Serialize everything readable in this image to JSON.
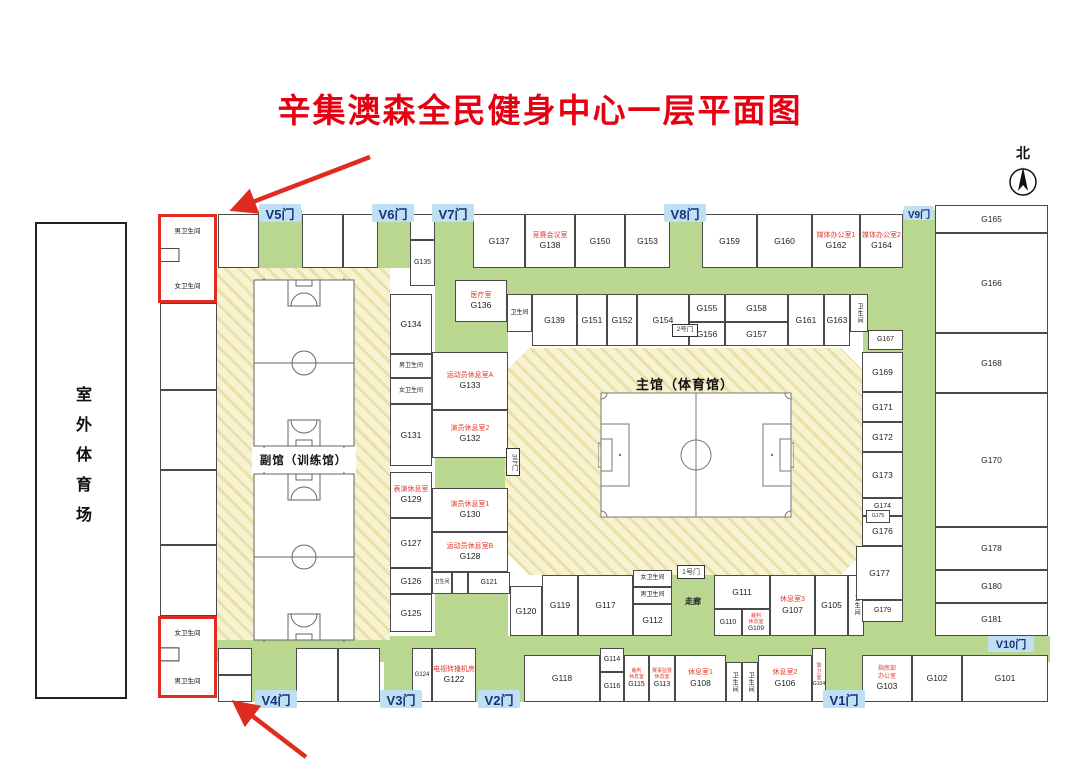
{
  "title": "辛集澳森全民健身中心一层平面图",
  "compass_label": "北",
  "labels": {
    "outdoor": "室外体育场",
    "training": "副馆（训练馆）",
    "main": "主馆（体育馆）",
    "corridor": "走廊"
  },
  "colors": {
    "title_red": "#e60012",
    "annotation_red": "#e02b20",
    "corridor_green": "#b9d78e",
    "door_bg": "#bfe0f2",
    "door_text": "#1b2f7e",
    "hatch_base": "#f7f2d0"
  },
  "entrance_doors": [
    {
      "label": "V5门",
      "x": 259,
      "y": 204,
      "w": 42,
      "h": 18,
      "fs": 13
    },
    {
      "label": "V6门",
      "x": 372,
      "y": 204,
      "w": 42,
      "h": 18,
      "fs": 13
    },
    {
      "label": "V7门",
      "x": 432,
      "y": 204,
      "w": 42,
      "h": 18,
      "fs": 13
    },
    {
      "label": "V8门",
      "x": 664,
      "y": 204,
      "w": 42,
      "h": 18,
      "fs": 13
    },
    {
      "label": "V9门",
      "x": 904,
      "y": 206,
      "w": 30,
      "h": 14,
      "fs": 10
    },
    {
      "label": "V10门",
      "x": 988,
      "y": 636,
      "w": 46,
      "h": 16,
      "fs": 11
    },
    {
      "label": "V1门",
      "x": 823,
      "y": 690,
      "w": 42,
      "h": 18,
      "fs": 13
    },
    {
      "label": "V2门",
      "x": 478,
      "y": 690,
      "w": 42,
      "h": 18,
      "fs": 13
    },
    {
      "label": "V3门",
      "x": 380,
      "y": 690,
      "w": 42,
      "h": 18,
      "fs": 13
    },
    {
      "label": "V4门",
      "x": 255,
      "y": 690,
      "w": 42,
      "h": 18,
      "fs": 13
    }
  ],
  "inner_doors": [
    {
      "label": "1号门",
      "x": 677,
      "y": 565,
      "w": 26,
      "h": 12,
      "fs": 7
    },
    {
      "label": "2号门",
      "x": 672,
      "y": 324,
      "w": 24,
      "h": 11,
      "fs": 6.5
    },
    {
      "label": "3号门",
      "x": 506,
      "y": 448,
      "w": 12,
      "h": 26,
      "fs": 6.5,
      "v": 1
    }
  ],
  "corridors": [
    {
      "x": 258,
      "y": 210,
      "w": 44,
      "h": 58
    },
    {
      "x": 378,
      "y": 210,
      "w": 32,
      "h": 58
    },
    {
      "x": 435,
      "y": 210,
      "w": 38,
      "h": 84
    },
    {
      "x": 670,
      "y": 210,
      "w": 32,
      "h": 84
    },
    {
      "x": 903,
      "y": 210,
      "w": 32,
      "h": 452
    },
    {
      "x": 435,
      "y": 268,
      "w": 468,
      "h": 26
    },
    {
      "x": 435,
      "y": 294,
      "w": 73,
      "h": 342
    },
    {
      "x": 863,
      "y": 294,
      "w": 40,
      "h": 342
    },
    {
      "x": 215,
      "y": 636,
      "w": 835,
      "h": 26
    },
    {
      "x": 672,
      "y": 566,
      "w": 42,
      "h": 70
    },
    {
      "x": 250,
      "y": 640,
      "w": 46,
      "h": 62
    },
    {
      "x": 384,
      "y": 640,
      "w": 28,
      "h": 62
    },
    {
      "x": 476,
      "y": 640,
      "w": 48,
      "h": 62
    },
    {
      "x": 826,
      "y": 640,
      "w": 36,
      "h": 62
    },
    {
      "x": 203,
      "y": 452,
      "w": 14,
      "h": 20
    }
  ],
  "red_boxes": [
    {
      "x": 158,
      "y": 214,
      "w": 59,
      "h": 89,
      "top_label": "男卫生间",
      "bottom_label": "女卫生间"
    },
    {
      "x": 158,
      "y": 616,
      "w": 59,
      "h": 82,
      "top_label": "女卫生间",
      "bottom_label": "男卫生间"
    }
  ],
  "arrows": [
    {
      "x1": 370,
      "y1": 157,
      "x2": 237,
      "y2": 208
    },
    {
      "x1": 306,
      "y1": 757,
      "x2": 238,
      "y2": 705
    }
  ],
  "rooms": [
    {
      "l": "",
      "x": 218,
      "y": 214,
      "w": 41,
      "h": 54
    },
    {
      "l": "",
      "x": 302,
      "y": 214,
      "w": 41,
      "h": 54
    },
    {
      "l": "",
      "x": 343,
      "y": 214,
      "w": 35,
      "h": 54
    },
    {
      "l": "",
      "x": 410,
      "y": 214,
      "w": 25,
      "h": 26
    },
    {
      "l": "G135",
      "x": 410,
      "y": 240,
      "w": 25,
      "h": 46,
      "fs": 7
    },
    {
      "l": "G137",
      "x": 473,
      "y": 214,
      "w": 52,
      "h": 54
    },
    {
      "l": "G138",
      "r": "竞赛会议室",
      "x": 525,
      "y": 214,
      "w": 50,
      "h": 54
    },
    {
      "l": "G150",
      "x": 575,
      "y": 214,
      "w": 50,
      "h": 54
    },
    {
      "l": "G153",
      "x": 625,
      "y": 214,
      "w": 45,
      "h": 54
    },
    {
      "l": "G159",
      "x": 702,
      "y": 214,
      "w": 55,
      "h": 54
    },
    {
      "l": "G160",
      "x": 757,
      "y": 214,
      "w": 55,
      "h": 54
    },
    {
      "l": "G162",
      "r": "媒体办公室1",
      "x": 812,
      "y": 214,
      "w": 48,
      "h": 54
    },
    {
      "l": "G164",
      "r": "媒体办公室2",
      "x": 860,
      "y": 214,
      "w": 43,
      "h": 54
    },
    {
      "l": "",
      "x": 160,
      "y": 303,
      "w": 57,
      "h": 87
    },
    {
      "l": "",
      "x": 160,
      "y": 390,
      "w": 57,
      "h": 80
    },
    {
      "l": "",
      "x": 160,
      "y": 470,
      "w": 57,
      "h": 75
    },
    {
      "l": "",
      "x": 160,
      "y": 545,
      "w": 57,
      "h": 71
    },
    {
      "l": "G136",
      "r": "医疗室",
      "x": 455,
      "y": 280,
      "w": 52,
      "h": 42
    },
    {
      "l": "卫生间",
      "x": 507,
      "y": 294,
      "w": 25,
      "h": 38,
      "fs": 6
    },
    {
      "l": "G139",
      "x": 532,
      "y": 294,
      "w": 45,
      "h": 52
    },
    {
      "l": "G151",
      "x": 577,
      "y": 294,
      "w": 30,
      "h": 52
    },
    {
      "l": "G152",
      "x": 607,
      "y": 294,
      "w": 30,
      "h": 52
    },
    {
      "l": "G154",
      "x": 637,
      "y": 294,
      "w": 52,
      "h": 52
    },
    {
      "l": "G155",
      "x": 689,
      "y": 294,
      "w": 36,
      "h": 28
    },
    {
      "l": "G156",
      "x": 689,
      "y": 322,
      "w": 36,
      "h": 24
    },
    {
      "l": "G158",
      "x": 725,
      "y": 294,
      "w": 63,
      "h": 28
    },
    {
      "l": "G157",
      "x": 725,
      "y": 322,
      "w": 63,
      "h": 24
    },
    {
      "l": "G161",
      "x": 788,
      "y": 294,
      "w": 36,
      "h": 52
    },
    {
      "l": "G163",
      "x": 824,
      "y": 294,
      "w": 26,
      "h": 52
    },
    {
      "l": "卫生间",
      "x": 850,
      "y": 294,
      "w": 18,
      "h": 38,
      "v": 1,
      "fs": 6
    },
    {
      "l": "G134",
      "x": 390,
      "y": 294,
      "w": 42,
      "h": 60
    },
    {
      "l": "男卫生间",
      "x": 390,
      "y": 354,
      "w": 42,
      "h": 24,
      "fs": 6
    },
    {
      "l": "女卫生间",
      "x": 390,
      "y": 378,
      "w": 42,
      "h": 26,
      "fs": 6
    },
    {
      "l": "G131",
      "x": 390,
      "y": 404,
      "w": 42,
      "h": 62
    },
    {
      "l": "G129",
      "r": "表演休息室",
      "x": 390,
      "y": 472,
      "w": 42,
      "h": 46
    },
    {
      "l": "G127",
      "x": 390,
      "y": 518,
      "w": 42,
      "h": 50
    },
    {
      "l": "G126",
      "x": 390,
      "y": 568,
      "w": 42,
      "h": 26
    },
    {
      "l": "G125",
      "x": 390,
      "y": 594,
      "w": 42,
      "h": 38
    },
    {
      "l": "G133",
      "r": "运动员休息室A",
      "x": 432,
      "y": 352,
      "w": 76,
      "h": 58
    },
    {
      "l": "G132",
      "r": "演员休息室2",
      "x": 432,
      "y": 410,
      "w": 76,
      "h": 48
    },
    {
      "l": "G130",
      "r": "演员休息室1",
      "x": 432,
      "y": 488,
      "w": 76,
      "h": 44
    },
    {
      "l": "G128",
      "r": "运动员休息室B",
      "x": 432,
      "y": 532,
      "w": 76,
      "h": 40
    },
    {
      "l": "卫生间",
      "x": 432,
      "y": 572,
      "w": 20,
      "h": 22,
      "fs": 5
    },
    {
      "l": "",
      "x": 452,
      "y": 572,
      "w": 16,
      "h": 22
    },
    {
      "l": "G121",
      "x": 468,
      "y": 572,
      "w": 42,
      "h": 22,
      "fs": 7
    },
    {
      "l": "G120",
      "x": 510,
      "y": 586,
      "w": 32,
      "h": 50
    },
    {
      "l": "G119",
      "x": 542,
      "y": 575,
      "w": 36,
      "h": 61
    },
    {
      "l": "G117",
      "x": 578,
      "y": 575,
      "w": 55,
      "h": 61
    },
    {
      "l": "女卫生间",
      "x": 633,
      "y": 570,
      "w": 39,
      "h": 17,
      "fs": 6
    },
    {
      "l": "男卫生间",
      "x": 633,
      "y": 587,
      "w": 39,
      "h": 17,
      "fs": 6
    },
    {
      "l": "G112",
      "x": 633,
      "y": 604,
      "w": 39,
      "h": 32
    },
    {
      "l": "G111",
      "x": 714,
      "y": 575,
      "w": 56,
      "h": 34
    },
    {
      "l": "G110",
      "x": 714,
      "y": 609,
      "w": 28,
      "h": 27,
      "fs": 7
    },
    {
      "l": "G109",
      "r": "裁判\n休息室",
      "x": 742,
      "y": 609,
      "w": 28,
      "h": 27,
      "fs": 6.5,
      "rfs": 5
    },
    {
      "l": "G107",
      "r": "休息室3",
      "x": 770,
      "y": 575,
      "w": 45,
      "h": 61
    },
    {
      "l": "G105",
      "x": 815,
      "y": 575,
      "w": 33,
      "h": 61
    },
    {
      "l": "卫生间",
      "x": 848,
      "y": 575,
      "w": 16,
      "h": 61,
      "v": 1,
      "fs": 6
    },
    {
      "l": "G167",
      "x": 868,
      "y": 330,
      "w": 35,
      "h": 20,
      "fs": 7
    },
    {
      "l": "G169",
      "x": 862,
      "y": 352,
      "w": 41,
      "h": 40
    },
    {
      "l": "G171",
      "x": 862,
      "y": 392,
      "w": 41,
      "h": 30
    },
    {
      "l": "G172",
      "x": 862,
      "y": 422,
      "w": 41,
      "h": 30
    },
    {
      "l": "G173",
      "x": 862,
      "y": 452,
      "w": 41,
      "h": 46
    },
    {
      "l": "G174",
      "x": 862,
      "y": 498,
      "w": 41,
      "h": 18,
      "fs": 7
    },
    {
      "l": "G176",
      "x": 862,
      "y": 516,
      "w": 41,
      "h": 30
    },
    {
      "l": "G175",
      "x": 866,
      "y": 510,
      "w": 24,
      "h": 13,
      "fs": 5
    },
    {
      "l": "G177",
      "x": 856,
      "y": 546,
      "w": 47,
      "h": 54
    },
    {
      "l": "G179",
      "x": 862,
      "y": 600,
      "w": 41,
      "h": 22,
      "fs": 7
    },
    {
      "l": "G165",
      "x": 935,
      "y": 205,
      "w": 113,
      "h": 28
    },
    {
      "l": "G166",
      "x": 935,
      "y": 233,
      "w": 113,
      "h": 100
    },
    {
      "l": "G168",
      "x": 935,
      "y": 333,
      "w": 113,
      "h": 60
    },
    {
      "l": "G170",
      "x": 935,
      "y": 393,
      "w": 113,
      "h": 134
    },
    {
      "l": "G178",
      "x": 935,
      "y": 527,
      "w": 113,
      "h": 43
    },
    {
      "l": "G180",
      "x": 935,
      "y": 570,
      "w": 113,
      "h": 33
    },
    {
      "l": "G181",
      "x": 935,
      "y": 603,
      "w": 113,
      "h": 33
    },
    {
      "l": "",
      "x": 218,
      "y": 648,
      "w": 34,
      "h": 27
    },
    {
      "l": "",
      "x": 218,
      "y": 675,
      "w": 34,
      "h": 27
    },
    {
      "l": "",
      "x": 296,
      "y": 648,
      "w": 42,
      "h": 54
    },
    {
      "l": "",
      "x": 338,
      "y": 648,
      "w": 42,
      "h": 54
    },
    {
      "l": "G124",
      "x": 412,
      "y": 648,
      "w": 20,
      "h": 54,
      "fs": 6
    },
    {
      "l": "G122",
      "r": "电视转播机房",
      "x": 432,
      "y": 648,
      "w": 44,
      "h": 54
    },
    {
      "l": "G118",
      "x": 524,
      "y": 655,
      "w": 76,
      "h": 47
    },
    {
      "l": "G114",
      "x": 600,
      "y": 648,
      "w": 24,
      "h": 24,
      "fs": 7
    },
    {
      "l": "G116",
      "x": 600,
      "y": 672,
      "w": 24,
      "h": 30,
      "fs": 7
    },
    {
      "l": "G115",
      "r": "裁判\n休息室",
      "x": 624,
      "y": 655,
      "w": 25,
      "h": 47,
      "fs": 7,
      "rfs": 5
    },
    {
      "l": "G113",
      "r": "赛事监督\n休息室",
      "x": 649,
      "y": 655,
      "w": 26,
      "h": 47,
      "fs": 7,
      "rfs": 5
    },
    {
      "l": "G108",
      "r": "休息室1",
      "x": 675,
      "y": 655,
      "w": 51,
      "h": 47
    },
    {
      "l": "卫生间",
      "x": 726,
      "y": 662,
      "w": 16,
      "h": 40,
      "v": 1,
      "fs": 6
    },
    {
      "l": "卫生间",
      "x": 742,
      "y": 662,
      "w": 16,
      "h": 40,
      "v": 1,
      "fs": 6
    },
    {
      "l": "G106",
      "r": "休息室2",
      "x": 758,
      "y": 655,
      "w": 54,
      "h": 47
    },
    {
      "l": "G104",
      "r": "警\n卫\n室",
      "x": 812,
      "y": 648,
      "w": 14,
      "h": 54,
      "fs": 5,
      "rfs": 5
    },
    {
      "l": "G103",
      "r": "指挥部\n办公室",
      "x": 862,
      "y": 655,
      "w": 50,
      "h": 47,
      "rfs": 6
    },
    {
      "l": "G102",
      "x": 912,
      "y": 655,
      "w": 50,
      "h": 47
    },
    {
      "l": "G101",
      "x": 962,
      "y": 655,
      "w": 86,
      "h": 47
    }
  ]
}
